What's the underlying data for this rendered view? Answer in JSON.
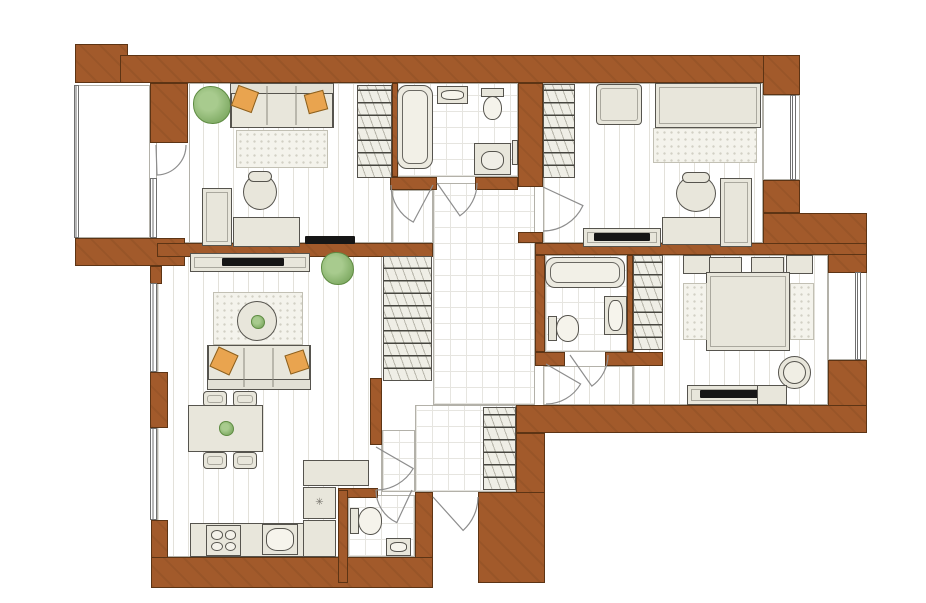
{
  "canvas": {
    "w": 926,
    "h": 603,
    "background": "#ffffff"
  },
  "palette": {
    "wall": "#a25a2b",
    "wall_outline": "#5d3414",
    "furniture": "#e8e6db",
    "plant": "#8cb571",
    "pillow": "#e9a44f",
    "tv": "#161616"
  },
  "symbols": {
    "fridge_snowflake": "✳"
  },
  "plan": {
    "floors": [
      {
        "name": "office",
        "pattern": "plank",
        "x": 157,
        "y": 83,
        "w": 235,
        "h": 160
      },
      {
        "name": "office-door-nook",
        "pattern": "plain",
        "x": 156,
        "y": 83,
        "w": 34,
        "h": 160
      },
      {
        "name": "office-closet-strip",
        "pattern": "plank",
        "x": 392,
        "y": 190,
        "w": 41,
        "h": 53
      },
      {
        "name": "balcony",
        "pattern": "plain",
        "x": 78,
        "y": 85,
        "w": 72,
        "h": 153
      },
      {
        "name": "bathroom-1",
        "pattern": "tile",
        "x": 397,
        "y": 83,
        "w": 121,
        "h": 94
      },
      {
        "name": "kids-room",
        "pattern": "plank",
        "x": 543,
        "y": 83,
        "w": 220,
        "h": 160
      },
      {
        "name": "hallway",
        "pattern": "tile",
        "x": 433,
        "y": 183,
        "w": 102,
        "h": 222
      },
      {
        "name": "bathroom-2",
        "pattern": "tile",
        "x": 545,
        "y": 255,
        "w": 82,
        "h": 97
      },
      {
        "name": "master-bedroom",
        "pattern": "plank",
        "x": 633,
        "y": 255,
        "w": 195,
        "h": 150
      },
      {
        "name": "master-corridor",
        "pattern": "plank",
        "x": 543,
        "y": 366,
        "w": 90,
        "h": 39
      },
      {
        "name": "living-kitchen",
        "pattern": "plank",
        "x": 157,
        "y": 255,
        "w": 225,
        "h": 302
      },
      {
        "name": "entrance",
        "pattern": "tile",
        "x": 415,
        "y": 405,
        "w": 101,
        "h": 87
      },
      {
        "name": "entrance-side",
        "pattern": "tile",
        "x": 382,
        "y": 430,
        "w": 33,
        "h": 62
      },
      {
        "name": "wc",
        "pattern": "tile",
        "x": 348,
        "y": 495,
        "w": 67,
        "h": 62
      },
      {
        "name": "kids-window-bay",
        "pattern": "plain",
        "x": 763,
        "y": 95,
        "w": 37,
        "h": 85
      },
      {
        "name": "master-window-bay",
        "pattern": "plain",
        "x": 828,
        "y": 272,
        "w": 39,
        "h": 88
      }
    ],
    "walls": [
      {
        "x": 75,
        "y": 44,
        "w": 53,
        "h": 39
      },
      {
        "x": 120,
        "y": 55,
        "w": 645,
        "h": 28
      },
      {
        "x": 763,
        "y": 55,
        "w": 37,
        "h": 40
      },
      {
        "x": 763,
        "y": 180,
        "w": 37,
        "h": 33
      },
      {
        "x": 763,
        "y": 213,
        "w": 104,
        "h": 37
      },
      {
        "x": 828,
        "y": 250,
        "w": 39,
        "h": 23
      },
      {
        "x": 828,
        "y": 360,
        "w": 39,
        "h": 73
      },
      {
        "x": 516,
        "y": 405,
        "w": 351,
        "h": 28
      },
      {
        "x": 516,
        "y": 433,
        "w": 29,
        "h": 67
      },
      {
        "x": 478,
        "y": 492,
        "w": 67,
        "h": 91
      },
      {
        "x": 415,
        "y": 492,
        "w": 18,
        "h": 91
      },
      {
        "x": 151,
        "y": 557,
        "w": 282,
        "h": 31
      },
      {
        "x": 151,
        "y": 520,
        "w": 17,
        "h": 38
      },
      {
        "x": 75,
        "y": 238,
        "w": 110,
        "h": 28
      },
      {
        "x": 150,
        "y": 266,
        "w": 12,
        "h": 18
      },
      {
        "x": 150,
        "y": 372,
        "w": 18,
        "h": 56
      },
      {
        "x": 157,
        "y": 243,
        "w": 276,
        "h": 14
      },
      {
        "x": 535,
        "y": 243,
        "w": 332,
        "h": 12
      },
      {
        "x": 518,
        "y": 83,
        "w": 25,
        "h": 104
      },
      {
        "x": 518,
        "y": 232,
        "w": 25,
        "h": 11
      },
      {
        "x": 150,
        "y": 83,
        "w": 38,
        "h": 60
      },
      {
        "x": 392,
        "y": 83,
        "w": 6,
        "h": 94
      },
      {
        "x": 390,
        "y": 177,
        "w": 47,
        "h": 13
      },
      {
        "x": 475,
        "y": 177,
        "w": 43,
        "h": 13
      },
      {
        "x": 535,
        "y": 255,
        "w": 10,
        "h": 97
      },
      {
        "x": 627,
        "y": 255,
        "w": 6,
        "h": 97
      },
      {
        "x": 535,
        "y": 352,
        "w": 30,
        "h": 14
      },
      {
        "x": 605,
        "y": 352,
        "w": 58,
        "h": 14
      },
      {
        "x": 370,
        "y": 378,
        "w": 12,
        "h": 67
      },
      {
        "x": 338,
        "y": 488,
        "w": 40,
        "h": 10
      },
      {
        "x": 338,
        "y": 490,
        "w": 10,
        "h": 93
      }
    ],
    "windows": [
      {
        "name": "balcony-glazing",
        "x": 74,
        "y": 85,
        "w": 5,
        "h": 153
      },
      {
        "name": "office-balcony-window",
        "x": 150,
        "y": 178,
        "w": 7,
        "h": 60
      },
      {
        "name": "living-window-1",
        "x": 150,
        "y": 283,
        "w": 7,
        "h": 89
      },
      {
        "name": "living-window-2",
        "x": 150,
        "y": 428,
        "w": 7,
        "h": 92
      },
      {
        "name": "kids-window",
        "x": 790,
        "y": 95,
        "w": 6,
        "h": 85
      },
      {
        "name": "master-window",
        "x": 855,
        "y": 272,
        "w": 6,
        "h": 88
      }
    ],
    "doors": [
      {
        "name": "balcony",
        "cx": 156,
        "cy": 145,
        "r": 30,
        "a0": 0,
        "a1": 88
      },
      {
        "name": "office",
        "cx": 433,
        "cy": 185,
        "r": 42,
        "a0": 180,
        "a1": 118
      },
      {
        "name": "bathroom-1",
        "cx": 437,
        "cy": 183,
        "r": 40,
        "a0": 0,
        "a1": 55
      },
      {
        "name": "kids-room",
        "cx": 543,
        "cy": 187,
        "r": 44,
        "a0": 90,
        "a1": 25
      },
      {
        "name": "bathroom-2",
        "cx": 570,
        "cy": 355,
        "r": 38,
        "a0": 0,
        "a1": 55
      },
      {
        "name": "master-bedroom",
        "cx": 546,
        "cy": 364,
        "r": 40,
        "a0": 90,
        "a1": 30
      },
      {
        "name": "kitchen",
        "cx": 376,
        "cy": 447,
        "r": 43,
        "a0": 90,
        "a1": 30
      },
      {
        "name": "wc",
        "cx": 412,
        "cy": 490,
        "r": 36,
        "a0": 180,
        "a1": 115
      },
      {
        "name": "entrance",
        "cx": 433,
        "cy": 497,
        "r": 45,
        "a0": 0,
        "a1": 48
      }
    ],
    "furniture": [
      {
        "name": "office-plant",
        "kind": "plant",
        "x": 193,
        "y": 86,
        "w": 38,
        "h": 38
      },
      {
        "name": "office-sofa",
        "kind": "sofa",
        "variant": "back-top",
        "x": 230,
        "y": 83,
        "w": 104,
        "h": 45
      },
      {
        "name": "office-sofa-pillow-left",
        "kind": "pillow",
        "x": 234,
        "y": 88,
        "w": 22,
        "h": 22,
        "rot": 20
      },
      {
        "name": "office-sofa-pillow-right",
        "kind": "pillow",
        "x": 306,
        "y": 92,
        "w": 20,
        "h": 20,
        "rot": -15
      },
      {
        "name": "office-rug",
        "kind": "rug",
        "x": 236,
        "y": 130,
        "w": 92,
        "h": 38
      },
      {
        "name": "office-cabinet",
        "kind": "box2",
        "x": 202,
        "y": 188,
        "w": 30,
        "h": 58
      },
      {
        "name": "office-desk",
        "kind": "furn",
        "x": 233,
        "y": 217,
        "w": 67,
        "h": 30
      },
      {
        "name": "office-chair",
        "kind": "roundchair",
        "x": 243,
        "y": 174,
        "w": 34,
        "h": 36
      },
      {
        "name": "office-tv",
        "kind": "tv",
        "x": 305,
        "y": 236,
        "w": 50,
        "h": 8
      },
      {
        "name": "office-wardrobe",
        "kind": "wardrobe",
        "x": 357,
        "y": 85,
        "w": 35,
        "h": 93
      },
      {
        "name": "living-tv-stand",
        "kind": "box2",
        "x": 190,
        "y": 253,
        "w": 120,
        "h": 19
      },
      {
        "name": "living-tv",
        "kind": "tv",
        "x": 222,
        "y": 258,
        "w": 62,
        "h": 8
      },
      {
        "name": "living-plant",
        "kind": "plant",
        "x": 321,
        "y": 252,
        "w": 33,
        "h": 33
      },
      {
        "name": "living-rug",
        "kind": "rug",
        "x": 213,
        "y": 292,
        "w": 90,
        "h": 53
      },
      {
        "name": "living-round-table",
        "kind": "circle",
        "x": 237,
        "y": 301,
        "w": 40,
        "h": 40
      },
      {
        "name": "living-table-plant",
        "kind": "plant",
        "x": 251,
        "y": 315,
        "w": 14,
        "h": 14
      },
      {
        "name": "living-sofa",
        "kind": "sofa",
        "variant": "back-bottom",
        "x": 207,
        "y": 345,
        "w": 104,
        "h": 45
      },
      {
        "name": "living-sofa-pillow-left",
        "kind": "pillow",
        "x": 213,
        "y": 350,
        "w": 22,
        "h": 22,
        "rot": 25
      },
      {
        "name": "living-sofa-pillow-right",
        "kind": "pillow",
        "x": 287,
        "y": 352,
        "w": 20,
        "h": 20,
        "rot": -18
      },
      {
        "name": "dining-chair-1",
        "kind": "chair",
        "x": 203,
        "y": 391,
        "w": 24,
        "h": 16
      },
      {
        "name": "dining-chair-2",
        "kind": "chair",
        "x": 233,
        "y": 391,
        "w": 24,
        "h": 16
      },
      {
        "name": "dining-table",
        "kind": "furn",
        "x": 188,
        "y": 405,
        "w": 75,
        "h": 47
      },
      {
        "name": "dining-table-plant",
        "kind": "plant",
        "x": 219,
        "y": 421,
        "w": 15,
        "h": 15
      },
      {
        "name": "dining-chair-3",
        "kind": "chair",
        "x": 203,
        "y": 452,
        "w": 24,
        "h": 17
      },
      {
        "name": "dining-chair-4",
        "kind": "chair",
        "x": 233,
        "y": 452,
        "w": 24,
        "h": 17
      },
      {
        "name": "kitchen-counter",
        "kind": "furn",
        "x": 190,
        "y": 523,
        "w": 146,
        "h": 34
      },
      {
        "name": "kitchen-stove",
        "kind": "stove",
        "x": 206,
        "y": 525,
        "w": 35,
        "h": 31
      },
      {
        "name": "kitchen-sink",
        "kind": "sink",
        "x": 262,
        "y": 524,
        "w": 36,
        "h": 31
      },
      {
        "name": "kitchen-counter-column",
        "kind": "furn",
        "x": 303,
        "y": 520,
        "w": 33,
        "h": 37
      },
      {
        "name": "kitchen-fridge",
        "kind": "fridge",
        "x": 303,
        "y": 487,
        "w": 33,
        "h": 32,
        "bind": "symbols.fridge_snowflake"
      },
      {
        "name": "kitchen-counter-top",
        "kind": "furn",
        "x": 303,
        "y": 460,
        "w": 66,
        "h": 26
      },
      {
        "name": "hall-coat-closet",
        "kind": "wardrobe",
        "x": 383,
        "y": 256,
        "w": 49,
        "h": 125
      },
      {
        "name": "kids-wardrobe",
        "kind": "wardrobe",
        "x": 543,
        "y": 84,
        "w": 32,
        "h": 94
      },
      {
        "name": "kids-armchair",
        "kind": "chair",
        "x": 596,
        "y": 84,
        "w": 46,
        "h": 41
      },
      {
        "name": "kids-bed",
        "kind": "bed",
        "x": 655,
        "y": 83,
        "w": 106,
        "h": 45
      },
      {
        "name": "kids-rug",
        "kind": "rug",
        "x": 653,
        "y": 128,
        "w": 104,
        "h": 35
      },
      {
        "name": "kids-desk-chair",
        "kind": "roundchair",
        "x": 676,
        "y": 175,
        "w": 40,
        "h": 37
      },
      {
        "name": "kids-desk",
        "kind": "furn",
        "x": 662,
        "y": 217,
        "w": 59,
        "h": 28
      },
      {
        "name": "kids-desk-side",
        "kind": "box2",
        "x": 720,
        "y": 178,
        "w": 32,
        "h": 69
      },
      {
        "name": "kids-tv-stand",
        "kind": "box2",
        "x": 583,
        "y": 228,
        "w": 78,
        "h": 19
      },
      {
        "name": "kids-tv",
        "kind": "tv",
        "x": 594,
        "y": 233,
        "w": 56,
        "h": 8
      },
      {
        "name": "master-wardrobe",
        "kind": "wardrobe",
        "x": 633,
        "y": 255,
        "w": 30,
        "h": 95
      },
      {
        "name": "master-nightstand-left",
        "kind": "furn",
        "x": 683,
        "y": 255,
        "w": 28,
        "h": 19
      },
      {
        "name": "master-nightstand-right",
        "kind": "furn",
        "x": 786,
        "y": 255,
        "w": 27,
        "h": 19
      },
      {
        "name": "master-pillow-left",
        "kind": "furn",
        "x": 709,
        "y": 257,
        "w": 33,
        "h": 16
      },
      {
        "name": "master-pillow-right",
        "kind": "furn",
        "x": 751,
        "y": 257,
        "w": 33,
        "h": 16
      },
      {
        "name": "master-bed",
        "kind": "bed",
        "x": 706,
        "y": 272,
        "w": 84,
        "h": 79
      },
      {
        "name": "master-rug-left",
        "kind": "rug",
        "x": 683,
        "y": 283,
        "w": 24,
        "h": 57
      },
      {
        "name": "master-rug-right",
        "kind": "rug",
        "x": 790,
        "y": 283,
        "w": 24,
        "h": 57
      },
      {
        "name": "master-chair",
        "kind": "ring",
        "x": 778,
        "y": 356,
        "w": 33,
        "h": 33
      },
      {
        "name": "master-tv-stand",
        "kind": "box2",
        "x": 687,
        "y": 385,
        "w": 100,
        "h": 20
      },
      {
        "name": "master-tv",
        "kind": "tv",
        "x": 700,
        "y": 390,
        "w": 60,
        "h": 8
      },
      {
        "name": "master-tv-cabinet",
        "kind": "furn",
        "x": 757,
        "y": 385,
        "w": 30,
        "h": 20
      },
      {
        "name": "bathtub-1",
        "kind": "tub",
        "x": 397,
        "y": 85,
        "w": 36,
        "h": 84
      },
      {
        "name": "bathroom1-sink",
        "kind": "sink",
        "x": 437,
        "y": 86,
        "w": 31,
        "h": 18
      },
      {
        "name": "bathroom1-toilet",
        "kind": "toilet",
        "variant": "t-down",
        "x": 479,
        "y": 88,
        "w": 27,
        "h": 32
      },
      {
        "name": "bathroom1-shelf",
        "kind": "furn",
        "x": 512,
        "y": 140,
        "w": 6,
        "h": 25
      },
      {
        "name": "washing-machine",
        "kind": "washer",
        "x": 474,
        "y": 143,
        "w": 37,
        "h": 32
      },
      {
        "name": "bathtub-2",
        "kind": "tub",
        "x": 545,
        "y": 257,
        "w": 80,
        "h": 31
      },
      {
        "name": "bathroom2-toilet",
        "kind": "toilet",
        "variant": "t-right",
        "x": 548,
        "y": 314,
        "w": 31,
        "h": 29
      },
      {
        "name": "bathroom2-vanity",
        "kind": "sink",
        "x": 604,
        "y": 296,
        "w": 23,
        "h": 39
      },
      {
        "name": "wc-toilet",
        "kind": "toilet",
        "variant": "t-right",
        "x": 350,
        "y": 506,
        "w": 32,
        "h": 30
      },
      {
        "name": "wc-sink",
        "kind": "sink",
        "x": 386,
        "y": 538,
        "w": 25,
        "h": 18
      },
      {
        "name": "entrance-wardrobe",
        "kind": "wardrobe",
        "x": 483,
        "y": 407,
        "w": 33,
        "h": 83
      }
    ]
  }
}
